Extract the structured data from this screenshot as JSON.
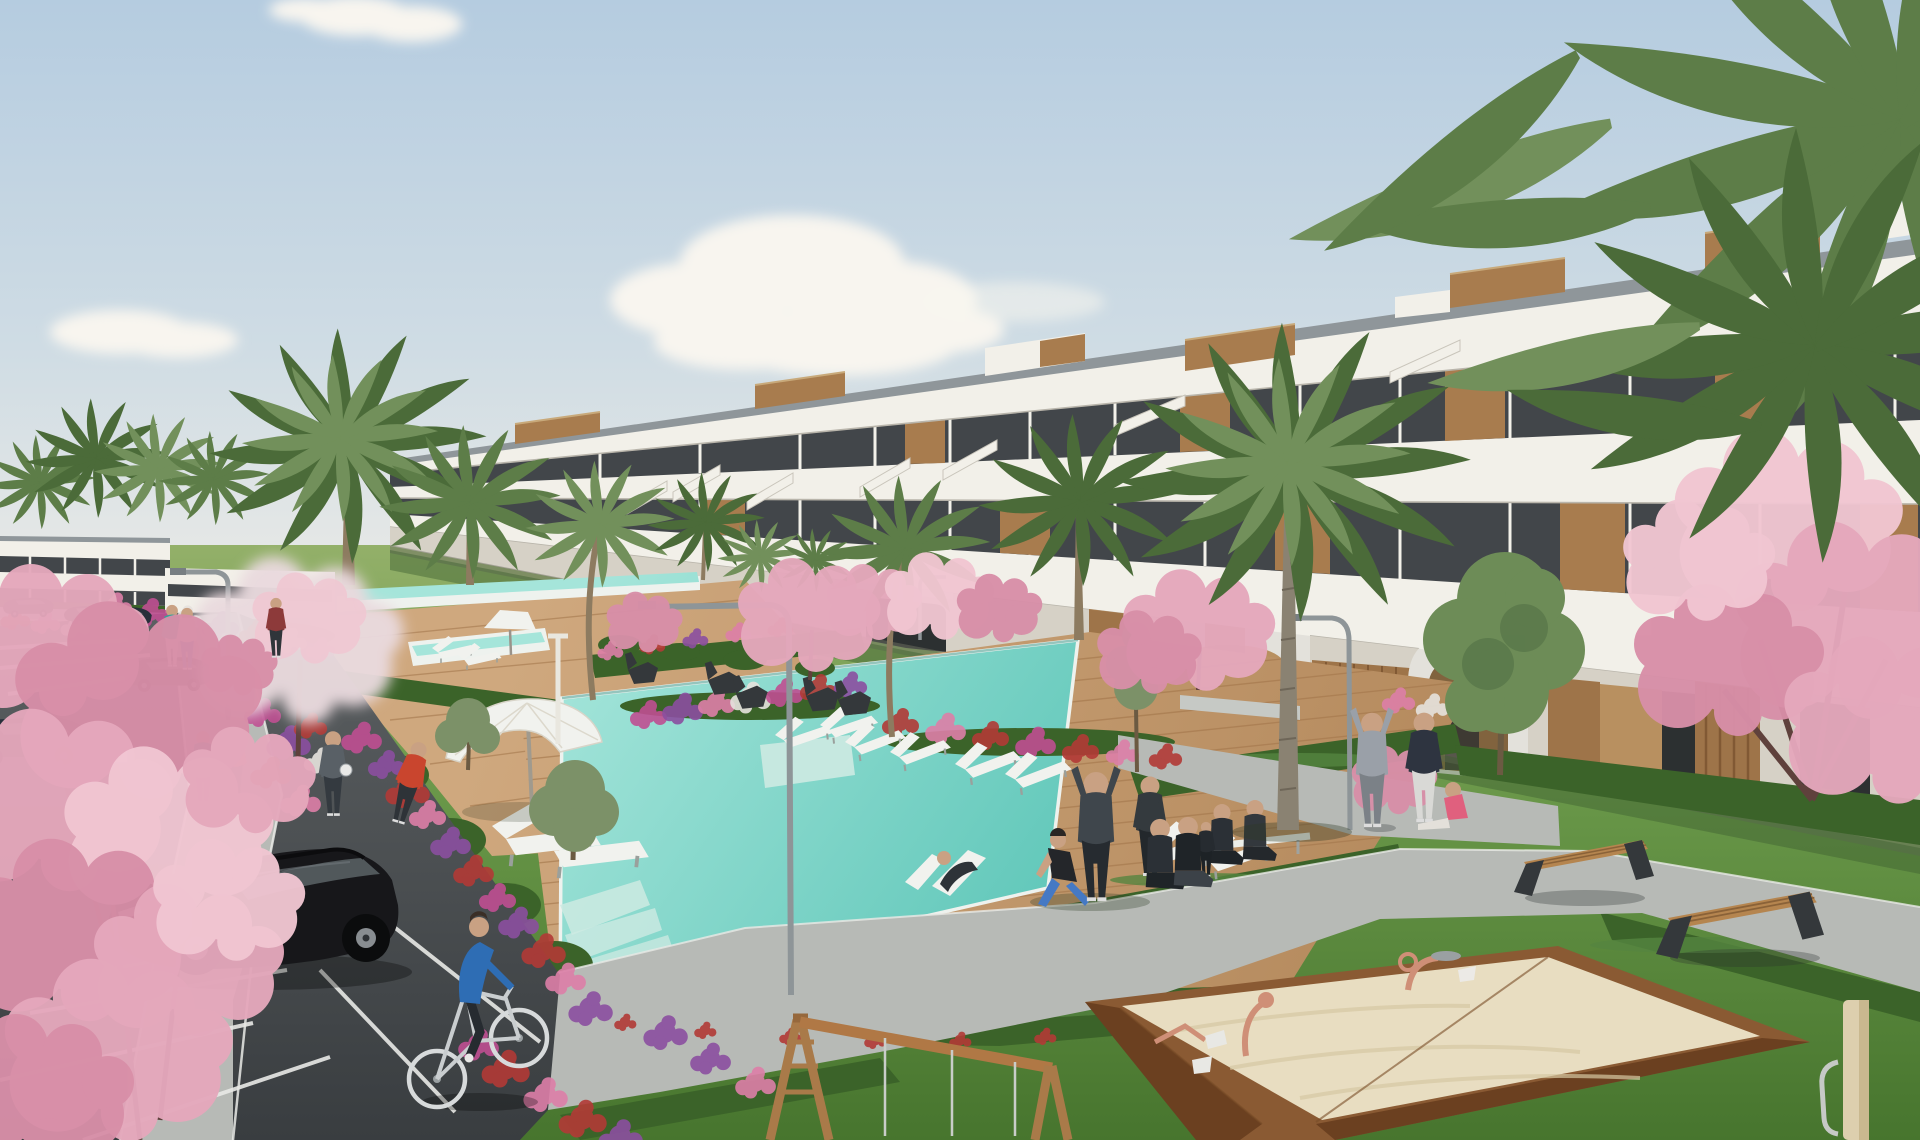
{
  "scene": {
    "type": "photorealistic-architectural-render",
    "subject": "modern terraced apartment complex with communal pool, gardens, parking lot and playground",
    "elements": [
      "sky",
      "clouds",
      "apartment-building",
      "distant-building",
      "palm-trees",
      "pink-blossom-trees",
      "swimming-pool",
      "upper-lap-pool",
      "wooden-pool-deck",
      "sun-loungers",
      "white-parasol",
      "street-lamps",
      "lawns",
      "hedges",
      "flower-beds",
      "walking-paths",
      "parking-lot",
      "parked-cars",
      "black-hatchback-car",
      "cyclist",
      "pedestrians",
      "yoga-group",
      "park-benches",
      "sandbox-playground",
      "wooden-swing-frame"
    ]
  },
  "palette": {
    "sky-top": "#b5cce0",
    "sky-mid": "#cfdce4",
    "sky-low": "#e6e8e6",
    "cloud": "#f8f5ef",
    "bldg": "#f2f0e9",
    "bldg-shade": "#e4dfd3",
    "roof-cap": "#8f969a",
    "slab-line": "#b9b5ab",
    "glass": "#42464a",
    "glass-hi": "#646a6e",
    "mullion": "#f3f1ea",
    "wood": "#a87c4e",
    "wood-dark": "#875e36",
    "wood-lite": "#c09a6a",
    "tan-wall": "#c49a66",
    "opening": "#2f3335",
    "opening-warm": "#8a6a42",
    "lawn-hi": "#93b069",
    "lawn": "#679547",
    "lawn-lo": "#47752e",
    "lawn-shadow": "#3e6030",
    "hedge": "#3b6329",
    "hedge-hi": "#558540",
    "pool-hi": "#a5e5da",
    "pool": "#57c3b5",
    "pool-rim": "#eef2ee",
    "pool-step": "#cdeae2",
    "deck-hi": "#cfa87e",
    "deck-lo": "#b2875a",
    "plank": "#a5794e",
    "path": "#b7bab6",
    "path-hi": "#c6c9c5",
    "curb": "#e9eae6",
    "asphalt": "#5c6062",
    "asphalt-lo": "#393d40",
    "line": "#e8e9e6",
    "car-black": "#17171a",
    "car-dark": "#272f3a",
    "car-glass": "#646a6e",
    "rim": "#888d91",
    "palm-dark": "#4b6b39",
    "palm-mid": "#5d7d48",
    "palm-lite": "#72905b",
    "trunk": "#8d7b60",
    "trunk-gray": "#8a8272",
    "pink": "#e5a8bc",
    "pink-lite": "#f1c6d2",
    "pink-deep": "#d88fa8",
    "bloom-white": "#eadade",
    "branch": "#5f413c",
    "sand": "#e8ddc1",
    "sand-lo": "#d6c7a3",
    "box-wood": "#8a5a33",
    "box-wood-lo": "#6b4020",
    "copper": "#cf8f77",
    "metal": "#9aa0a2",
    "furn": "#f1f2ee",
    "bench-wood": "#b5854f",
    "leg": "#34383b",
    "lamp": "#8e9598",
    "skin": "#c9a183",
    "shoe": "#dddddd",
    "teal": "#2fa69a",
    "pinktop": "#e58fa0",
    "red": "#c9452e",
    "blue": "#2e6db4",
    "gray": "#596066",
    "darkcloth": "#262b30",
    "hoodie": "#9aa0a8",
    "jeans": "#4579c4",
    "whitecloth": "#d9d9d6",
    "bike": "#d7dadb",
    "fl-magenta": "#bf4f92",
    "fl-purple": "#8b4fa0",
    "fl-red": "#b23a36",
    "fl-pinkd": "#dd7fa8",
    "fl-white": "#e6e3de",
    "shadow": "#2e3a26"
  }
}
